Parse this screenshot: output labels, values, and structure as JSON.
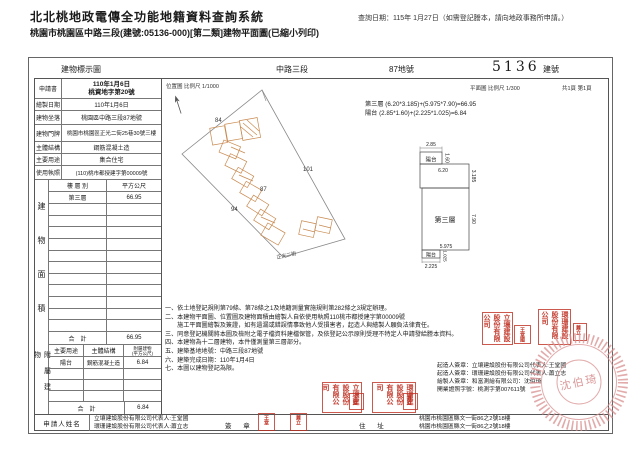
{
  "header": {
    "system_title": "北北桃地政電傳全功能地籍資料查詢系統",
    "query_date": "查詢日期：115年 1月27日（如需登記謄本，請向地政事務所申請。）",
    "doc_subtitle": "桃園市桃園區中路三段(建號:05136-000)[第二類]建物平面圖(已縮小列印)"
  },
  "title_bar": {
    "map_label": "建物標示圖",
    "section": "中路三段",
    "land_no": "87地號",
    "building_no": "5136",
    "building_no_suffix": "建號"
  },
  "info": {
    "r1_label": "申請書",
    "r1_line1": "110年1月6日",
    "r1_line2": "桃資地字第20號",
    "r2_label": "繪製日期",
    "r2_value": "110年1月6日",
    "r3_label": "建物坐落",
    "r3_value": "桃園區中路三段87地號",
    "r4_label": "建物門牌",
    "r4_value": "桃園市桃園區正光二街25巷30號三樓",
    "r5_label": "主體結構",
    "r5_value": "鋼筋混凝土造",
    "r6_label": "主要用途",
    "r6_value": "集合住宅",
    "r7_label": "使用執照",
    "r7_value": "(110)桃市都授建字第00009號"
  },
  "floor_table": {
    "side": "建物面積",
    "h1": "樓 層 別",
    "h2": "平方公尺",
    "row_label": "第三層",
    "row_value": "66.95",
    "total_label": "合　計",
    "total_value": "66.95"
  },
  "accessory_table": {
    "side": "附屬建物",
    "h1": "主要用途",
    "h2": "主體結構",
    "h3": "附屬建物",
    "h3b": "(平方公尺)",
    "row_use": "陽台",
    "row_structure": "鋼筋混凝土造",
    "row_value": "6.84",
    "total_label": "合　計",
    "total_value": "6.84"
  },
  "applicant": {
    "name_label": "申請人姓名",
    "name1": "立壤建設股份有限公司代表人:王堂國",
    "name2": "環珊建設股份有限公司代表人:蕭立志",
    "sign_label": "簽 章",
    "addr_label": "住 址",
    "addr1": "桃園市桃園區縣文一街86之2號18樓",
    "addr2": "桃園市桃園區縣文一街86之2號18樓"
  },
  "drawing": {
    "location_scale": "位置圖 比例尺  1/1000",
    "plan_scale": "平面圖 比例尺  1/300",
    "page_no": "共1頁 第1頁",
    "formula1": "第三層 (6.20*3.185)+(5.975*7.90)=66.95",
    "formula2": "陽台 (2.85*1.60)+(2.225*1.025)=6.84",
    "site": {
      "lot_a": "84",
      "lot_b": "101",
      "lot_c": "87",
      "lot_d": "94",
      "street": "正光二街"
    },
    "plan": {
      "floor_label": "第三層",
      "balcony_top": "陽台",
      "balcony_bottom": "陽台",
      "dim_top_w": "2.85",
      "dim_top_h": "1.60",
      "dim_upper_w": "6.20",
      "dim_upper_h": "3.185",
      "dim_main_h": "7.90",
      "dim_main_w": "5.975",
      "dim_bot_w": "2.225",
      "dim_bot_h": "1.025"
    }
  },
  "notes": [
    "一、依土地登記規則第79條、第78條之1及地籍測量實施規則第282條之3規定辦理。",
    "二、本建物平面圖、位置圖及建物面積由繪製人自依使用執照110桃市都授建字第00009號",
    "　　施工平面圖繪製及簽證，如有遺漏或錯誤情事致他人受損害者，起造人與繪製人願負法律責任。",
    "三、同意登記機關將本圖及檢附之電子檔資料建檔保管，及依登記公示原則受理不特定人申請發給謄本資料。",
    "四、本建物為十二層建物，本件僅測量第三層部分。",
    "五、建築基地地號：中路三段87地號",
    "六、建築完成日期：110年1月4日",
    "七、本圖以建物登記為限。"
  ],
  "signatures": [
    "起造人簽章：立壤建設股份有限公司代表人:王堂國",
    "起造人簽章：環珊建設股份有限公司代表人:蕭立志",
    "繪製人簽章：和富測繪有限公司：沈伯琦",
    "開業證照字號：桃測字第007611號"
  ],
  "stamps": {
    "company1": "立壤建設股份有限公司",
    "rep1": "王堂國",
    "company2": "環珊建設股份有限公司",
    "rep2": "蕭立志",
    "surveyor": "沈伯琦"
  },
  "colors": {
    "stamp_red": "#bf3022",
    "seal_pink": "#d98f8f",
    "building_outline": "#c8894f"
  }
}
